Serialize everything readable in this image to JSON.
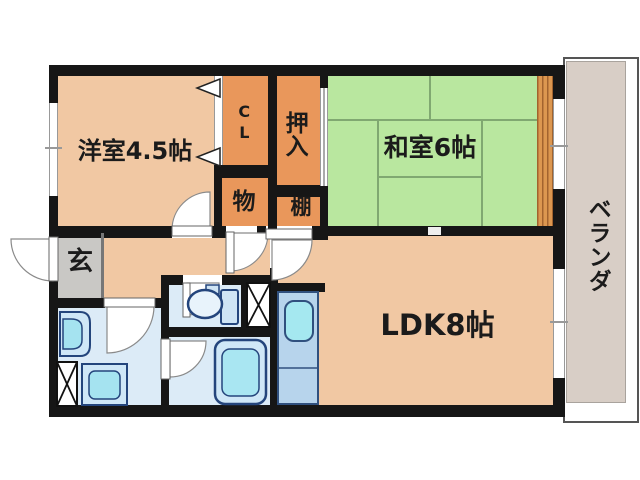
{
  "floorplan": {
    "rooms": {
      "western": {
        "label": "洋室4.5帖"
      },
      "japanese": {
        "label": "和室6帖"
      },
      "ldk": {
        "label": "LDK8帖"
      },
      "genkan": {
        "label": "玄"
      },
      "closet": {
        "label": "CL"
      },
      "oshiire": {
        "label": "押入"
      },
      "storage": {
        "label": "物"
      },
      "shelf": {
        "label": "棚"
      },
      "veranda": {
        "label": "ベランダ"
      }
    },
    "colors": {
      "room_peach": "#f1c8a3",
      "closet_orange": "#e9975b",
      "tatami_green": "#b9e79f",
      "tatami_line": "#80a871",
      "wood_strip": "#dc9750",
      "genkan_gray": "#c9c8c5",
      "veranda_taupe": "#d8cec6",
      "wet_area_blue": "#dcebf7",
      "fixture_fill": "#cfe7f7",
      "fixture_water": "#a5e3f0",
      "fixture_outline": "#24457c",
      "wall_black": "#161616"
    },
    "fixtures": {
      "toilet": "toilet-icon",
      "bathtub": "bathtub-icon",
      "vanity": "wash-basin-icon",
      "washer": "washing-machine-icon",
      "kitchen_sink": "kitchen-sink-icon",
      "pipe_shaft": "pipe-shaft-x-icon"
    }
  }
}
